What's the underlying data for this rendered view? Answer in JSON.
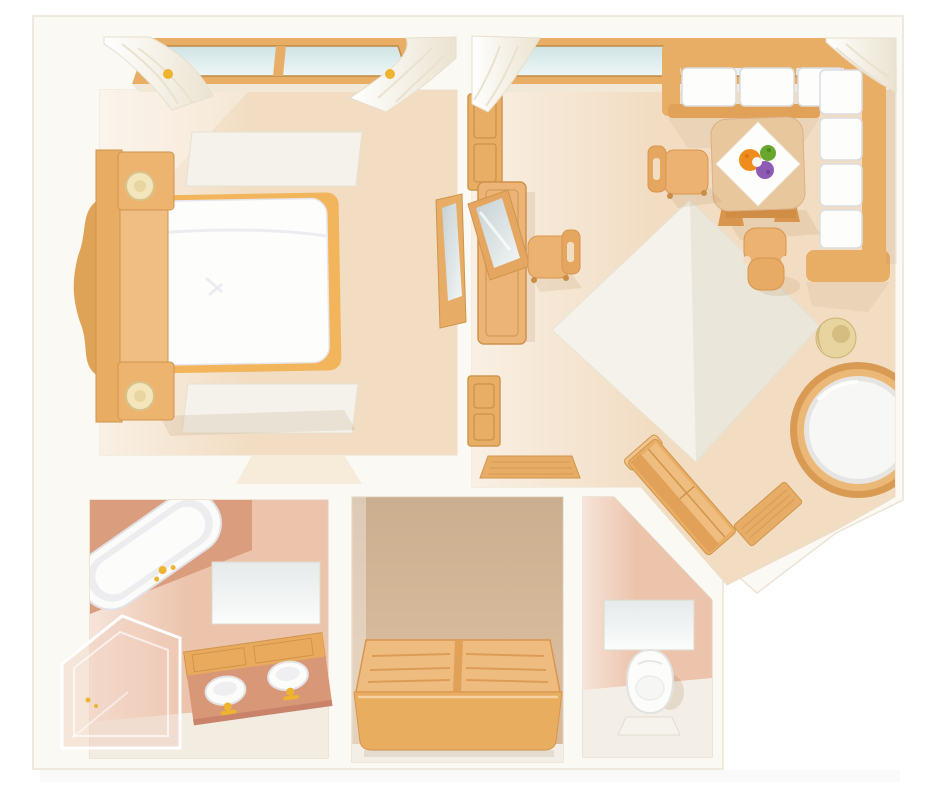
{
  "scene": {
    "kind": "apartment-floor-plan-illustration",
    "view": "top-down",
    "visible_text": [],
    "room_count": 5
  },
  "palette": {
    "page_bg": "#ffffff",
    "wall": "#fbf9f3",
    "wall_edge": "#ebe3d4",
    "floor_warm": "#f2ddc3",
    "floor_salmon": "#ecc3ab",
    "floor_tan": "#d7bb9c",
    "terracotta": "#da9d7e",
    "wood": "#e9ae66",
    "wood_dark": "#d6934b",
    "wood_light": "#f2c68d",
    "linen_white": "#fdfdfc",
    "cushion_edge": "#dadbe0",
    "glass_blue": "#d6e8e9",
    "mirror_glass": "#ccd7d9",
    "gold": "#eeb42f",
    "blanket_gold": "#f3b55b",
    "rug": "#f4f2ea",
    "flower_orange": "#ef8c1e",
    "flower_purple": "#8d5bb4",
    "flower_green": "#68a62f"
  },
  "rooms": [
    {
      "name": "bedroom",
      "position": "top-left",
      "items": [
        "window",
        "curtains",
        "rug",
        "double-bed-white-duvet",
        "carved-wood-headboard",
        "leaning-mirror",
        "doorway"
      ]
    },
    {
      "name": "living-room",
      "position": "top-right",
      "items": [
        "window",
        "curtains",
        "open-door",
        "console-table",
        "leaning-mirror",
        "dining-chair",
        "side-chair",
        "desk-chair",
        "l-shaped-sofa",
        "coffee-table",
        "napkin",
        "flower-bouquet",
        "diamond-rug",
        "round-table",
        "straw-hat",
        "diagonal-sideboard",
        "entry-doormat",
        "doormat"
      ]
    },
    {
      "name": "bathroom",
      "position": "bottom-left",
      "items": [
        "tub-platform",
        "bathtub",
        "wall-mirror",
        "double-sink-vanity",
        "glass-shower-enclosure"
      ]
    },
    {
      "name": "closet-room",
      "position": "bottom-center",
      "items": [
        "low-dresser"
      ]
    },
    {
      "name": "wc",
      "position": "bottom-right",
      "items": [
        "wall-mirror",
        "toilet",
        "bath-mat"
      ]
    }
  ]
}
